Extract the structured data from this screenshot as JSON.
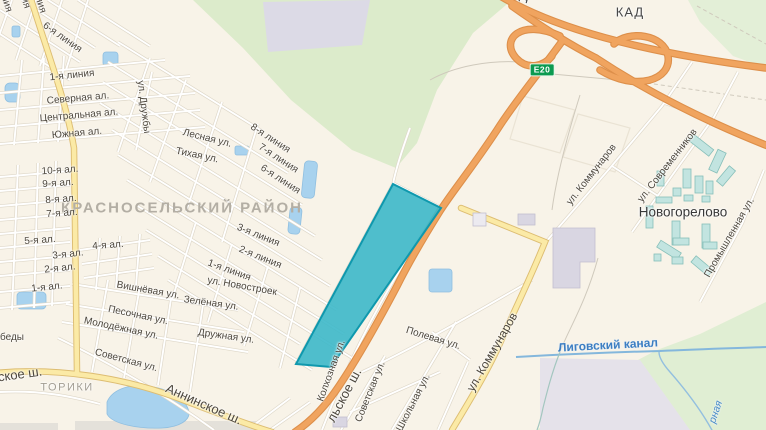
{
  "map": {
    "district_label": "КРАСНОСЕЛЬСКИЙ РАЙОН",
    "places": {
      "toriki": "ТОРИКИ",
      "novogorelovo": "Новогорелово"
    },
    "highways": {
      "kad": "КАД",
      "kad_clipped": "КАД",
      "e20_badge": "Е20",
      "anninskoe": "Аннинское ш.",
      "krasnoselskoe_fragment": "льское ш.",
      "skoe_fragment": "ское ш."
    },
    "water_labels": {
      "ligovsky_canal": "Лиговский канал",
      "chernaya_fragment": "рная"
    },
    "streets": {
      "liniya6_top": "6-я линия",
      "liniya1_top": "1-я линия",
      "severnaya": "Северная ал.",
      "centralnaya": "Центральная ал.",
      "yuzhnaya": "Южная ал.",
      "druzhby": "ул. Дружбы",
      "lesnaya": "Лесная ул.",
      "tihaya": "Тихая ул.",
      "liniya8": "8-я линия",
      "liniya7": "7-я линия",
      "liniya6_mid": "6-я линия",
      "al10": "10-я ал.",
      "al9": "9-я ал.",
      "al8": "8-я ал.",
      "al7": "7-я ал.",
      "al5": "5-я ал.",
      "al4": "4-я ал.",
      "al3": "3-я ал.",
      "al2": "2-я ал.",
      "al1": "1-я ал.",
      "liniya3": "3-я линия",
      "liniya2": "2-я линия",
      "liniya1_mid": "1-я линия",
      "novostroek": "ул. Новостроек",
      "vishnevaya": "Вишнёвая ул.",
      "zelenaya": "Зелёная ул.",
      "pesochnaya": "Песочная ул.",
      "molodezhnaya": "Молодёжная ул.",
      "pobedy_fragment": "беды",
      "sovetskaya_left": "Советская ул.",
      "druzhnaya": "Дружная ул.",
      "kolkhoznaya": "Колхозная ул.",
      "sovetskaya_right": "Советская ул.",
      "shkolnaya": "Школьная ул.",
      "polevaya": "Полевая ул.",
      "kommunarov_main": "ул. Коммунаров",
      "kommunarov_north": "ул. Коммунаров",
      "sovremennikov": "ул. Современников",
      "promyshlennaya": "Промышленная ул.",
      "fragment_top1": "ния",
      "fragment_top2": "ия",
      "fragment_top3": "ния"
    },
    "colors": {
      "selected_area_fill": "#3cb8c9",
      "selected_area_border": "#0f98ad",
      "motorway_orange": "#f0a45f",
      "road_yellow": "#fbeaa6",
      "water_blue": "#a8d2ee",
      "green_area": "#dcebcb",
      "e20_badge_green": "#0c9a50"
    }
  }
}
